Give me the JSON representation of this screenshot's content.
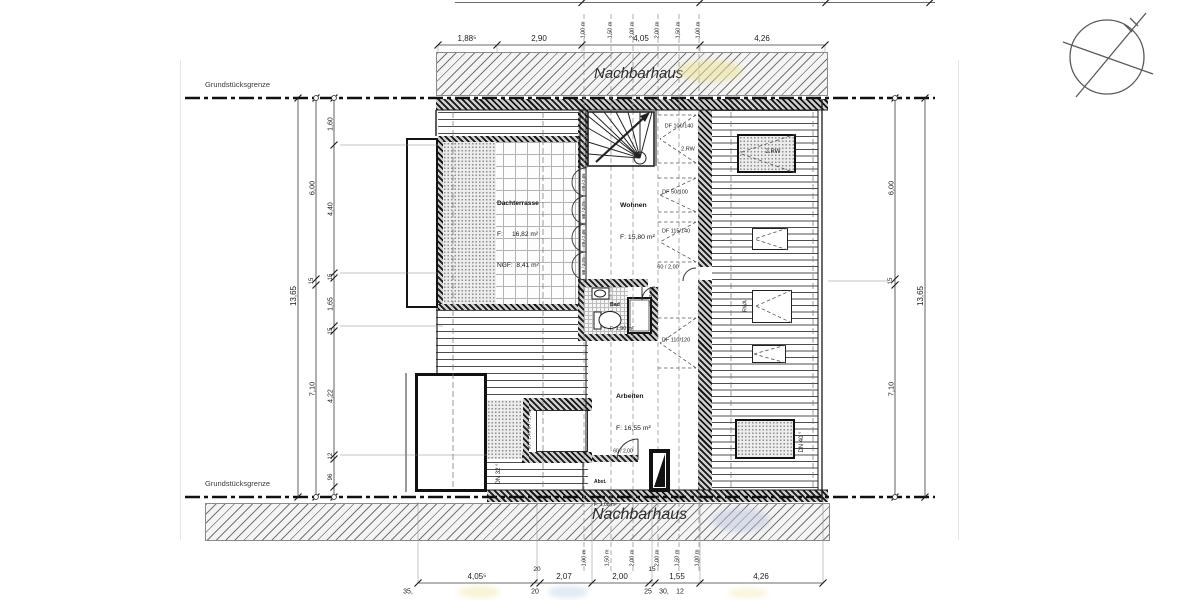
{
  "colors": {
    "line": "#222222",
    "band_fill": "#f4f4f4",
    "wall_dark": "#161616",
    "smudge_yellow": "#efe6a0",
    "smudge_blue": "#c3c9e0"
  },
  "labels": {
    "neighbor_top": "Nachbarhaus",
    "neighbor_bottom": "Nachbarhaus",
    "boundary_top": "Grundstücksgrenze",
    "boundary_bottom": "Grundstücksgrenze"
  },
  "rooms": {
    "dachterrasse": {
      "name": "Dachterrasse",
      "l1": "F:     16,82 m²",
      "l2": "NGF:  8,41 m²"
    },
    "wohnen": {
      "name": "Wohnen",
      "l1": "F: 15,80 m²"
    },
    "bad": {
      "name": "Bad",
      "l1": "F: 1,90 m²"
    },
    "arbeiten": {
      "name": "Arbeiten",
      "l1": "F: 16,55 m²"
    },
    "abst": {
      "name": "Abst.",
      "l1": "F: 1,08 m²"
    }
  },
  "annotations": [
    {
      "t": "DF 100/140",
      "x": 679,
      "y": 127,
      "s": 5.5,
      "n": "roof-window-label"
    },
    {
      "t": "2.RW",
      "x": 688,
      "y": 150,
      "s": 5.5,
      "n": "escape-route-label"
    },
    {
      "t": "DF 50/100",
      "x": 675,
      "y": 193,
      "s": 5.5,
      "n": "roof-window-label"
    },
    {
      "t": "DF 115/140",
      "x": 676,
      "y": 232,
      "s": 5.5,
      "n": "roof-window-label"
    },
    {
      "t": "60 / 2,00",
      "x": 668,
      "y": 268,
      "s": 5.5,
      "n": "door-size-label"
    },
    {
      "t": "DF 110/120",
      "x": 676,
      "y": 341,
      "s": 5.5,
      "n": "roof-window-label"
    },
    {
      "t": "2.RW",
      "x": 773,
      "y": 152,
      "s": 6,
      "n": "escape-route-label"
    },
    {
      "t": "RWA",
      "x": 746,
      "y": 306,
      "s": 5,
      "r": -90,
      "n": "smoke-vent-label"
    },
    {
      "t": "DN 40 °",
      "x": 802,
      "y": 442,
      "s": 6,
      "r": -90,
      "n": "roof-pitch-label"
    },
    {
      "t": "DN 32 °",
      "x": 499,
      "y": 474,
      "s": 6,
      "r": -90,
      "n": "roof-pitch-label"
    },
    {
      "t": "80 / 1,40  80 / 1,40",
      "x": 531,
      "y": 430,
      "s": 4.8,
      "r": -90,
      "n": "window-size-label"
    },
    {
      "t": "88 / 2,05",
      "x": 584,
      "y": 182,
      "s": 4.5,
      "r": -90,
      "n": "door-size-label"
    },
    {
      "t": "88 / 2,05",
      "x": 584,
      "y": 210,
      "s": 4.5,
      "r": -90,
      "n": "door-size-label"
    },
    {
      "t": "88 / 2,05",
      "x": 584,
      "y": 238,
      "s": 4.5,
      "r": -90,
      "n": "door-size-label"
    },
    {
      "t": "88 / 2,05",
      "x": 584,
      "y": 266,
      "s": 4.5,
      "r": -90,
      "n": "door-size-label"
    },
    {
      "t": "60 / 2,05",
      "x": 651,
      "y": 297,
      "s": 4.5,
      "r": -90,
      "n": "door-size-label"
    },
    {
      "t": "60 / 2,00",
      "x": 623,
      "y": 452,
      "s": 5,
      "n": "door-size-label"
    },
    {
      "t": "1,00 m",
      "x": 584,
      "y": 30,
      "s": 5.5,
      "r": -90,
      "n": "height-contour-label"
    },
    {
      "t": "1,50 m",
      "x": 611,
      "y": 30,
      "s": 5.5,
      "r": -90,
      "n": "height-contour-label"
    },
    {
      "t": "2,00 m",
      "x": 633,
      "y": 30,
      "s": 5.5,
      "r": -90,
      "n": "height-contour-label"
    },
    {
      "t": "2,00 m",
      "x": 658,
      "y": 30,
      "s": 5.5,
      "r": -90,
      "n": "height-contour-label"
    },
    {
      "t": "1,50 m",
      "x": 679,
      "y": 30,
      "s": 5.5,
      "r": -90,
      "n": "height-contour-label"
    },
    {
      "t": "1,00 m",
      "x": 699,
      "y": 30,
      "s": 5.5,
      "r": -90,
      "n": "height-contour-label"
    },
    {
      "t": "1,00 m",
      "x": 585,
      "y": 558,
      "s": 5.5,
      "r": -90,
      "n": "height-contour-label"
    },
    {
      "t": "1,50 m",
      "x": 608,
      "y": 558,
      "s": 5.5,
      "r": -90,
      "n": "height-contour-label"
    },
    {
      "t": "2,00 m",
      "x": 633,
      "y": 558,
      "s": 5.5,
      "r": -90,
      "n": "height-contour-label"
    },
    {
      "t": "2,00 m",
      "x": 658,
      "y": 558,
      "s": 5.5,
      "r": -90,
      "n": "height-contour-label"
    },
    {
      "t": "1,50 m",
      "x": 678,
      "y": 558,
      "s": 5.5,
      "r": -90,
      "n": "height-contour-label"
    },
    {
      "t": "1,00 m",
      "x": 698,
      "y": 558,
      "s": 5.5,
      "r": -90,
      "n": "height-contour-label"
    },
    {
      "t": "1,88⁵",
      "x": 467,
      "y": 39,
      "s": 8,
      "n": "dimension-label"
    },
    {
      "t": "2,90",
      "x": 539,
      "y": 39,
      "s": 8,
      "n": "dimension-label"
    },
    {
      "t": "4,05",
      "x": 641,
      "y": 39,
      "s": 8,
      "n": "dimension-label"
    },
    {
      "t": "4,26",
      "x": 762,
      "y": 39,
      "s": 8,
      "n": "dimension-label"
    },
    {
      "t": "4,05⁵",
      "x": 477,
      "y": 577,
      "s": 8,
      "n": "dimension-label"
    },
    {
      "t": "2,07",
      "x": 564,
      "y": 577,
      "s": 8,
      "n": "dimension-label"
    },
    {
      "t": "2,00",
      "x": 620,
      "y": 577,
      "s": 8,
      "n": "dimension-label"
    },
    {
      "t": "1,55",
      "x": 677,
      "y": 577,
      "s": 8,
      "n": "dimension-label"
    },
    {
      "t": "4,26",
      "x": 761,
      "y": 577,
      "s": 8,
      "n": "dimension-label"
    },
    {
      "t": "20",
      "x": 537,
      "y": 570,
      "s": 6.5,
      "n": "dimension-label"
    },
    {
      "t": "15",
      "x": 652,
      "y": 570,
      "s": 6.5,
      "n": "dimension-label"
    },
    {
      "t": "35,",
      "x": 408,
      "y": 592,
      "s": 7,
      "n": "dimension-label"
    },
    {
      "t": "20",
      "x": 535,
      "y": 592,
      "s": 7,
      "n": "dimension-label"
    },
    {
      "t": "25",
      "x": 648,
      "y": 592,
      "s": 7,
      "n": "dimension-label"
    },
    {
      "t": "30,",
      "x": 664,
      "y": 592,
      "s": 7,
      "n": "dimension-label"
    },
    {
      "t": "12",
      "x": 680,
      "y": 592,
      "s": 7,
      "n": "dimension-label"
    },
    {
      "t": "13,65",
      "x": 294,
      "y": 296,
      "s": 8,
      "r": -90,
      "n": "dimension-label"
    },
    {
      "t": "6,00",
      "x": 312,
      "y": 188,
      "s": 7.5,
      "r": -90,
      "n": "dimension-label"
    },
    {
      "t": "15",
      "x": 312,
      "y": 281,
      "s": 6,
      "r": -90,
      "n": "dimension-label"
    },
    {
      "t": "7,10",
      "x": 312,
      "y": 389,
      "s": 7.5,
      "r": -90,
      "n": "dimension-label"
    },
    {
      "t": "1,60",
      "x": 331,
      "y": 124,
      "s": 7,
      "r": -90,
      "n": "dimension-label"
    },
    {
      "t": "4,40",
      "x": 331,
      "y": 209,
      "s": 7,
      "r": -90,
      "n": "dimension-label"
    },
    {
      "t": "15",
      "x": 331,
      "y": 277,
      "s": 6,
      "r": -90,
      "n": "dimension-label"
    },
    {
      "t": "1,65",
      "x": 331,
      "y": 304,
      "s": 7,
      "r": -90,
      "n": "dimension-label"
    },
    {
      "t": "15",
      "x": 331,
      "y": 331,
      "s": 6,
      "r": -90,
      "n": "dimension-label"
    },
    {
      "t": "4,22",
      "x": 331,
      "y": 396,
      "s": 7,
      "r": -90,
      "n": "dimension-label"
    },
    {
      "t": "12",
      "x": 331,
      "y": 456,
      "s": 6,
      "r": -90,
      "n": "dimension-label"
    },
    {
      "t": "96",
      "x": 331,
      "y": 477,
      "s": 6,
      "r": -90,
      "n": "dimension-label"
    },
    {
      "t": "6,00",
      "x": 891,
      "y": 188,
      "s": 7.5,
      "r": -90,
      "n": "dimension-label"
    },
    {
      "t": "15",
      "x": 891,
      "y": 281,
      "s": 6,
      "r": -90,
      "n": "dimension-label"
    },
    {
      "t": "7,10",
      "x": 891,
      "y": 389,
      "s": 7.5,
      "r": -90,
      "n": "dimension-label"
    },
    {
      "t": "13,65",
      "x": 921,
      "y": 296,
      "s": 8,
      "r": -90,
      "n": "dimension-label"
    }
  ]
}
